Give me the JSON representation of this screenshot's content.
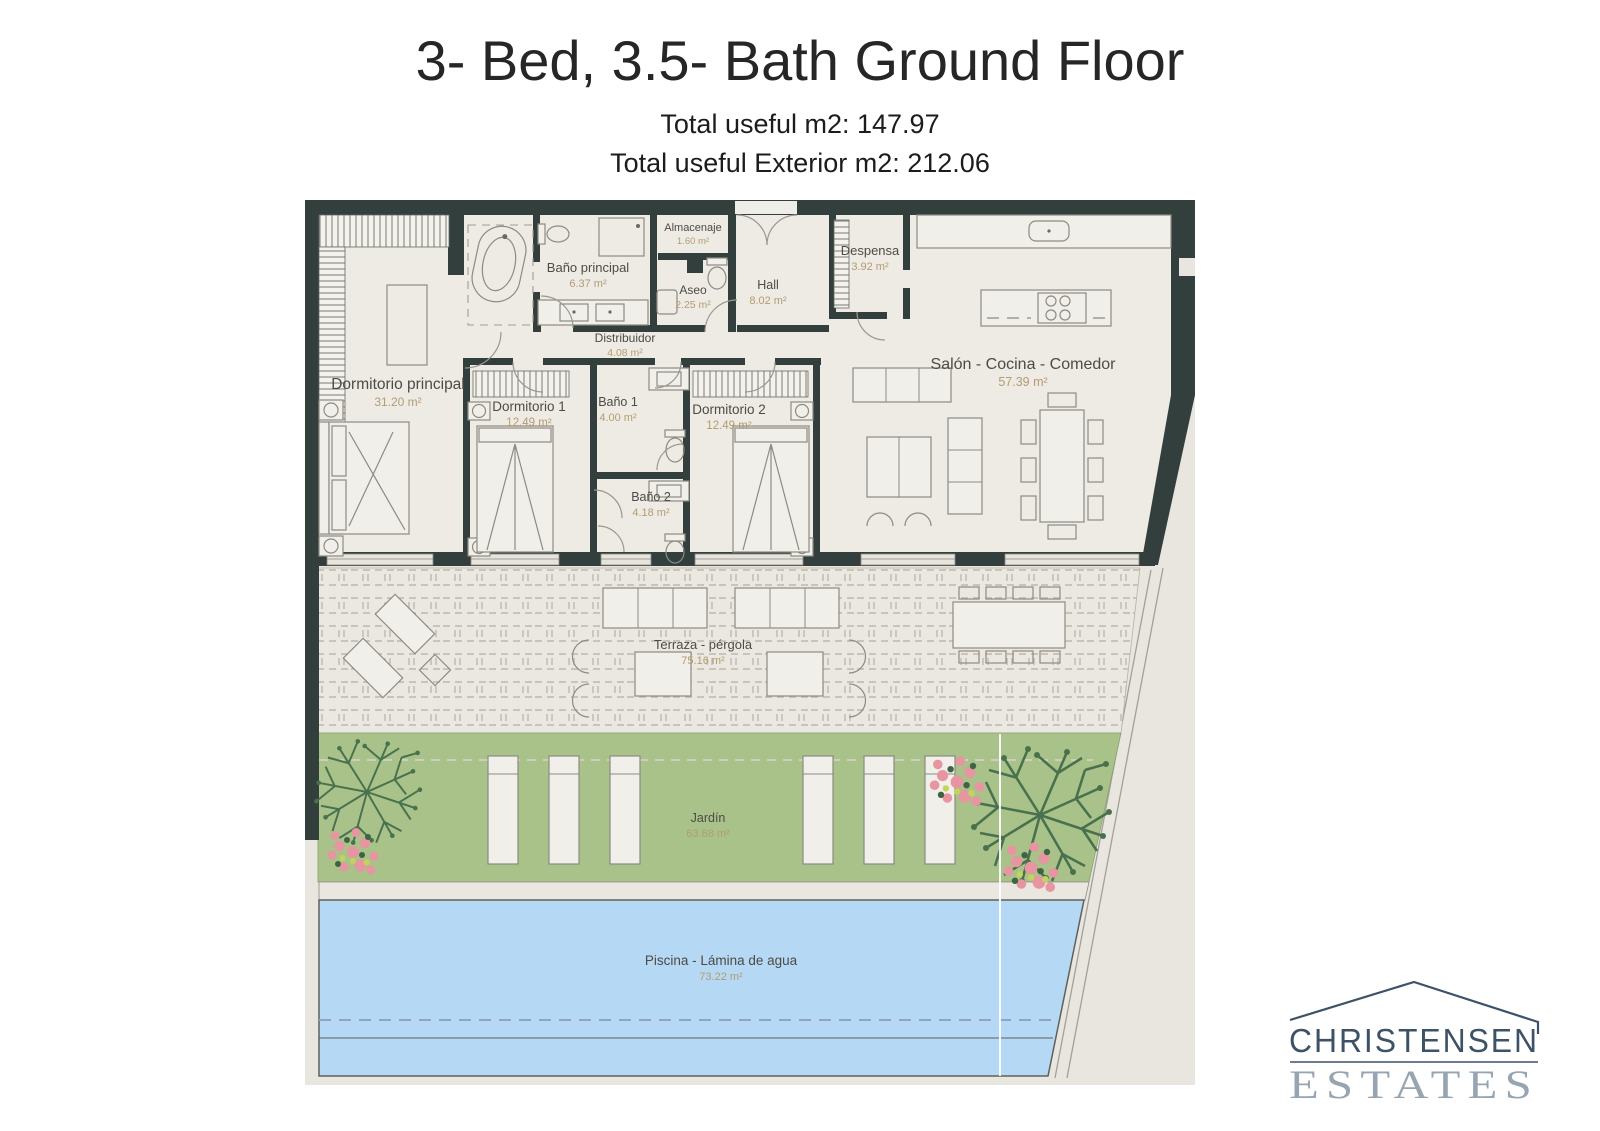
{
  "header": {
    "title": "3- Bed, 3.5- Bath Ground Floor",
    "subtitle1": "Total useful m2: 147.97",
    "subtitle2": "Total useful Exterior m2: 212.06"
  },
  "rooms": {
    "almacenaje": {
      "name": "Almacenaje",
      "area": "1.60 m²"
    },
    "bano_principal": {
      "name": "Baño principal",
      "area": "6.37 m²"
    },
    "aseo": {
      "name": "Aseo",
      "area": "2.25 m²"
    },
    "hall": {
      "name": "Hall",
      "area": "8.02 m²"
    },
    "despensa": {
      "name": "Despensa",
      "area": "3.92 m²"
    },
    "distribuidor": {
      "name": "Distribuidor",
      "area": "4.08 m²"
    },
    "dormitorio_principal": {
      "name": "Dormitorio principal",
      "area": "31.20 m²"
    },
    "dormitorio_1": {
      "name": "Dormitorio 1",
      "area": "12.49 m²"
    },
    "bano_1": {
      "name": "Baño 1",
      "area": "4.00 m²"
    },
    "dormitorio_2": {
      "name": "Dormitorio 2",
      "area": "12.49 m²"
    },
    "bano_2": {
      "name": "Baño 2",
      "area": "4.18 m²"
    },
    "salon": {
      "name": "Salón - Cocina - Comedor",
      "area": "57.39 m²"
    },
    "terraza": {
      "name": "Terraza - pérgola",
      "area": "75.16 m²"
    },
    "jardin": {
      "name": "Jardín",
      "area": "63.68 m²"
    },
    "piscina": {
      "name": "Piscina - Lámina de agua",
      "area": "73.22 m²"
    }
  },
  "logo": {
    "line1": "CHRISTENSEN",
    "line2": "ESTATES"
  },
  "colors": {
    "wall": "#333F3C",
    "floor": "#EDEBE4",
    "backdrop": "#E9E6E0",
    "terrace": "#EBE8E1",
    "garden": "#A8C28A",
    "pool": "#B5D9F4",
    "room_label": "#4E4A45",
    "area_label": "#B49B72",
    "logo_primary": "#3D5266",
    "logo_secondary": "#97A5B2"
  }
}
